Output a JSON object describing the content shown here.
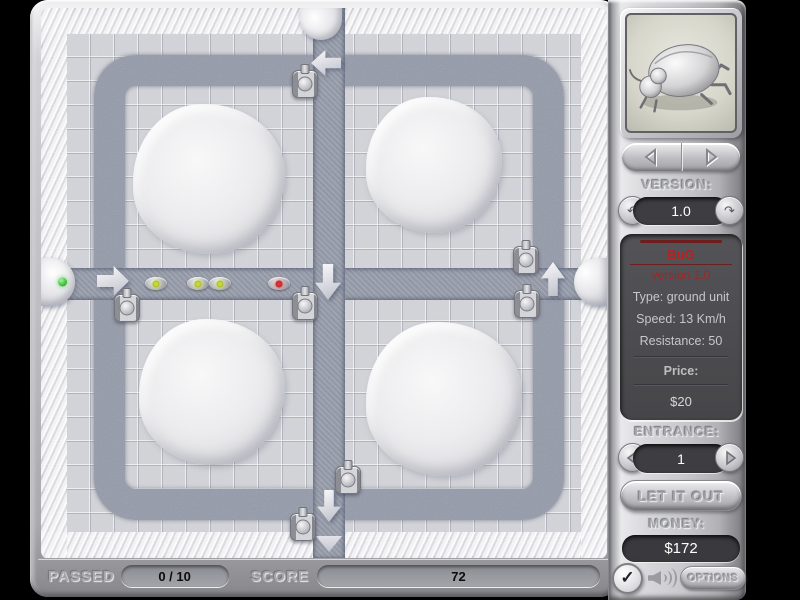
{
  "status": {
    "passed_label": "PASSED",
    "passed_value": "0 / 10",
    "score_label": "SCORE",
    "score_value": "72"
  },
  "panel": {
    "version_label": "VERSION:",
    "version_value": "1.0",
    "info": {
      "name": "BuG",
      "version": "version 1.0",
      "type": "Type: ground unit",
      "speed": "Speed: 13 Km/h",
      "resistance": "Resistance: 50",
      "price_label": "Price:",
      "price_value": "$20"
    },
    "entrance_label": "ENTRANCE:",
    "entrance_value": "1",
    "release_button": "LET IT OUT",
    "money_label": "MONEY:",
    "money_value": "$172",
    "options_button": "OPTIONS",
    "icons": {
      "unit_preview": "beetle-image",
      "nav_prev": "left-triangle",
      "nav_next": "right-triangle",
      "version_prev": "↶",
      "version_next": "↷",
      "entrance_prev": "left-triangle",
      "entrance_next": "right-triangle",
      "check": "✓",
      "volume": "speaker-waves"
    }
  },
  "board": {
    "mounds": [
      {
        "x": 92,
        "y": 96,
        "w": 152,
        "h": 150
      },
      {
        "x": 325,
        "y": 89,
        "w": 136,
        "h": 136
      },
      {
        "x": 98,
        "y": 311,
        "w": 146,
        "h": 146
      },
      {
        "x": 325,
        "y": 314,
        "w": 156,
        "h": 154
      }
    ],
    "entrances": [
      {
        "side": "left",
        "x": 0,
        "y": 250,
        "w": 34,
        "h": 48,
        "indicator": "green-dot"
      },
      {
        "side": "top",
        "x": 259,
        "y": 0,
        "w": 42,
        "h": 32
      },
      {
        "side": "right",
        "x": 533,
        "y": 250,
        "w": 33,
        "h": 48
      }
    ],
    "exit_marker": {
      "x": 275,
      "y": 528,
      "w": 26,
      "h": 16
    },
    "arrows": [
      {
        "dir": "right",
        "x": 56,
        "y": 258,
        "w": 32,
        "h": 30
      },
      {
        "dir": "left",
        "x": 270,
        "y": 42,
        "w": 30,
        "h": 26
      },
      {
        "dir": "down",
        "x": 274,
        "y": 256,
        "w": 26,
        "h": 36
      },
      {
        "dir": "up",
        "x": 500,
        "y": 254,
        "w": 24,
        "h": 34
      },
      {
        "dir": "down",
        "x": 276,
        "y": 482,
        "w": 24,
        "h": 32
      }
    ],
    "turrets": [
      {
        "x": 251,
        "y": 62
      },
      {
        "x": 472,
        "y": 238
      },
      {
        "x": 473,
        "y": 282
      },
      {
        "x": 73,
        "y": 286
      },
      {
        "x": 251,
        "y": 284
      },
      {
        "x": 294,
        "y": 458
      },
      {
        "x": 249,
        "y": 505
      }
    ],
    "bugs": [
      {
        "x": 103,
        "y": 268,
        "dot": "#cde23c"
      },
      {
        "x": 145,
        "y": 268,
        "dot": "#cde23c"
      },
      {
        "x": 167,
        "y": 268,
        "dot": "#cde23c"
      },
      {
        "x": 226,
        "y": 268,
        "dot": "#e23434"
      }
    ]
  },
  "colors": {
    "road": "#9298a6",
    "tile": "#d0d1d6",
    "accent_red": "#b42222",
    "dome_green": "#3dbb3d"
  }
}
